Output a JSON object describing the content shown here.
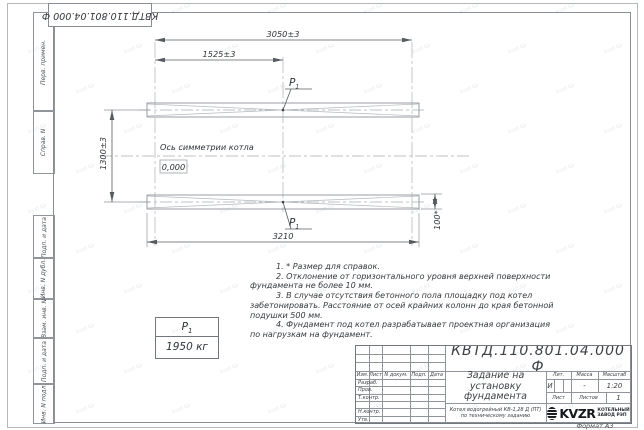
{
  "stamp": {
    "doc_number": "КВТД.110.801.04.000 Ф"
  },
  "margin": {
    "labels": [
      "Перв. примен.",
      "Справ. N",
      "Подп. и дата",
      "Инв. N дубл.",
      "Взам. инв. N",
      "Подп. и дата",
      "Инв. N подл."
    ]
  },
  "drawing": {
    "dim_3050": "3050±3",
    "dim_1525": "1525±3",
    "dim_1300": "1300±3",
    "dim_3210": "3210",
    "dim_100": "100*",
    "axis_label": "Ось симметрии котла",
    "elevation": "0,000",
    "load_symbol": "P",
    "load_symbol_sub": "1"
  },
  "load_table": {
    "value": "1950 кг"
  },
  "notes": {
    "lines": [
      "1. * Размер для справок.",
      "2. Отклонение от горизонтального уровня верхней поверхности",
      "фундамента не более 10 мм.",
      "3. В случае отсутствия бетонного пола площадку под котел",
      "забетонировать. Расстояние от осей крайних колонн до края бетонной",
      "подушки 500 мм.",
      "4. Фундамент под котел разрабатывает проектная организация",
      "по нагрузкам на фундамент."
    ]
  },
  "title_block": {
    "doc_number": "КВТД.110.801.04.000 Ф",
    "title": "Задание на установку фундамента",
    "product": "Котел водогрейный КВ-1,28 Д (ПТ) по техническому заданию",
    "col_izm": "Изм.",
    "col_list": "Лист",
    "col_doc": "N докум.",
    "col_podp": "Подп.",
    "col_data": "Дата",
    "row_razrab": "Разраб.",
    "row_prov": "Пров.",
    "row_tkontr": "Т.контр.",
    "row_nkontr": "Н.контр.",
    "row_utv": "Утв.",
    "lit_header": "Лит.",
    "mass_header": "Масса",
    "scale_header": "Масштаб",
    "lit_value": "И",
    "mass_value": "-",
    "scale_value": "1:20",
    "sheet_label": "Лист",
    "sheets_label": "Листов",
    "sheets_value": "1",
    "logo_text": "KVZR",
    "logo_line1": "КОТЕЛЬНЫЙ",
    "logo_line2": "ЗАВОД РЭП"
  },
  "footer": {
    "format_label": "Формат А3"
  },
  "watermark": {
    "text": "kvzr.kz"
  }
}
